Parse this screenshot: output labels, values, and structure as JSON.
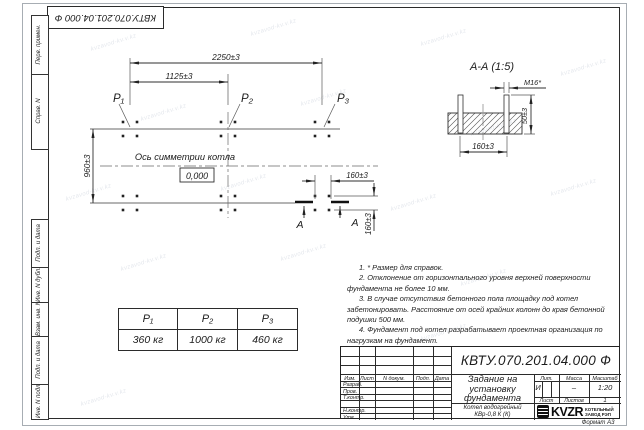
{
  "watermark": {
    "text": "kvzavod-kv.v.kz"
  },
  "corner_stamp": {
    "doc_number": "КВТУ.070.201.04.000  Ф"
  },
  "margin": {
    "perv": "Перв. примен.",
    "sprav": "Справ. N",
    "podp1": "Подп. и дата",
    "dubl": "Инв. N дубл.",
    "vzam": "Взам. инв. N",
    "podp2": "Подп. и дата",
    "podl": "Инв. N подл."
  },
  "plan": {
    "dim_2250": "2250±3",
    "dim_1125": "1125±3",
    "dim_960": "960±3",
    "dim_160_h": "160±3",
    "dim_160_v": "160±3",
    "load_p1": "P₁",
    "load_p2": "P₂",
    "load_p3": "P₃",
    "axis_label": "Ось симметрии котла",
    "level_mark": "0,000",
    "section_a1": "А",
    "section_a2": "А"
  },
  "section": {
    "title": "А-А (1:5)",
    "thread": "М16*",
    "dim_height": "50±3",
    "dim_spacing": "160±3"
  },
  "notes": [
    "1. * Размер для справок.",
    "2. Отклонение от горизонтального уровня верхней поверхности фундамента не более 10 мм.",
    "3. В случае отсутствия бетонного пола площадку под котел забетонировать. Расстояние от осей крайних колонн до края бетонной подушки 500 мм.",
    "4. Фундамент под котел разрабатывает проектная организация по нагрузкам на фундамент."
  ],
  "load_table": {
    "headers": [
      "P₁",
      "P₂",
      "P₃"
    ],
    "values": [
      "360 кг",
      "1000 кг",
      "460 кг"
    ]
  },
  "title_block": {
    "doc_number": "КВТУ.070.201.04.000  Ф",
    "name_l1": "Задание на",
    "name_l2": "установку",
    "name_l3": "фундамента",
    "product_l1": "Котел водогрейный",
    "product_l2": "КВр-0,8 К (К)",
    "hdr_izm": "Изм.",
    "hdr_list": "Лист",
    "hdr_ndoc": "N докум.",
    "hdr_podp": "Подп.",
    "hdr_data": "Дата",
    "row_razrab": "Разраб.",
    "row_prov": "Пров.",
    "row_tkontr": "Т.контр.",
    "row_nkontr": "Н.контр.",
    "row_utv": "Утв.",
    "lit_label": "Лит.",
    "lit_value": "И",
    "massa_label": "Масса",
    "massa_value": "–",
    "scale_label": "Масштаб",
    "scale_value": "1:20",
    "sheet_label": "Лист",
    "sheets_label": "Листов",
    "sheets_value": "1",
    "logo_text": "KVZR",
    "org_l1": "КОТЕЛЬНЫЙ",
    "org_l2": "ЗАВОД РЭП",
    "format_label": "Формат А3"
  }
}
